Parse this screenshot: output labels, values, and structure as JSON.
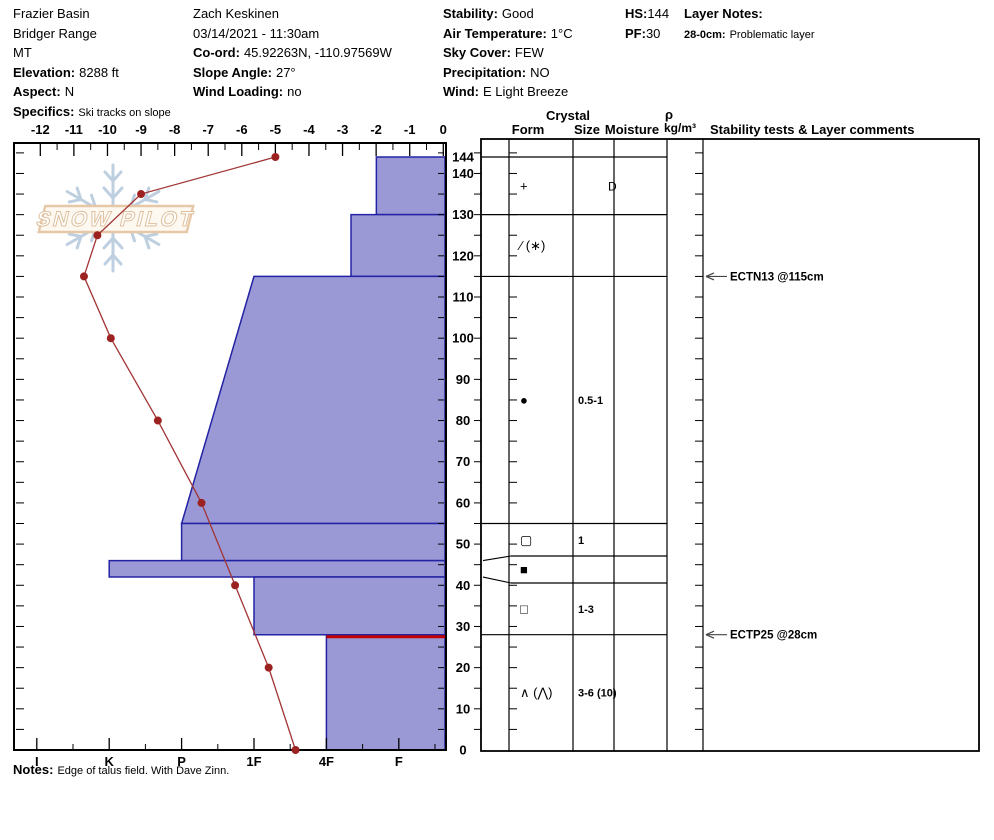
{
  "header": {
    "location": {
      "line1": "Frazier Basin",
      "line2": "Bridger Range",
      "line3": "MT",
      "elevation_label": "Elevation:",
      "elevation": "8288 ft",
      "aspect_label": "Aspect:",
      "aspect": "N",
      "specifics_label": "Specifics:",
      "specifics": "Ski tracks on slope"
    },
    "observer": {
      "name": "Zach Keskinen",
      "datetime": "03/14/2021 - 11:30am",
      "coord_label": "Co-ord:",
      "coord": "45.92263N, -110.97569W",
      "slope_label": "Slope Angle:",
      "slope": "27°",
      "wind_loading_label": "Wind Loading:",
      "wind_loading": "no"
    },
    "conditions": {
      "stability_label": "Stability:",
      "stability": "Good",
      "airtemp_label": "Air Temperature:",
      "airtemp": "1°C",
      "sky_label": "Sky Cover:",
      "sky": "FEW",
      "precip_label": "Precipitation:",
      "precip": "NO",
      "wind_label": "Wind:",
      "wind": "E Light Breeze"
    },
    "totals": {
      "hs_label": "HS:",
      "hs": "144",
      "pf_label": "PF:",
      "pf": "30"
    },
    "layer_notes": {
      "title": "Layer Notes:",
      "item_range": "28-0cm:",
      "item_text": "Problematic layer"
    }
  },
  "watermark": {
    "text": "SNOW PILOT",
    "snowflake_icon": "snowflake"
  },
  "chart_data": [
    {
      "type": "line",
      "name": "temperature-profile",
      "xlabel": "Temperature (°C)",
      "x_ticks": [
        -12,
        -11,
        -10,
        -9,
        -8,
        -7,
        -6,
        -5,
        -4,
        -3,
        -2,
        -1,
        0
      ],
      "xlim": [
        -12,
        0
      ],
      "color": "#a23535",
      "point_color": "#9c2222",
      "points": [
        {
          "depth_cm": 144,
          "temp_c": -5.0
        },
        {
          "depth_cm": 135,
          "temp_c": -9.0
        },
        {
          "depth_cm": 125,
          "temp_c": -10.3
        },
        {
          "depth_cm": 115,
          "temp_c": -10.7
        },
        {
          "depth_cm": 100,
          "temp_c": -9.9
        },
        {
          "depth_cm": 80,
          "temp_c": -8.5
        },
        {
          "depth_cm": 60,
          "temp_c": -7.2
        },
        {
          "depth_cm": 40,
          "temp_c": -6.2
        },
        {
          "depth_cm": 20,
          "temp_c": -5.2
        },
        {
          "depth_cm": 0,
          "temp_c": -4.4
        }
      ]
    },
    {
      "type": "bar",
      "name": "hand-hardness-profile",
      "orientation": "horizontal",
      "hardness_axis_labels": [
        "I",
        "K",
        "P",
        "1F",
        "4F",
        "F"
      ],
      "depth_axis_ticks": [
        144,
        140,
        130,
        120,
        110,
        100,
        90,
        80,
        70,
        60,
        50,
        40,
        30,
        20,
        10,
        0
      ],
      "ylim": [
        0,
        146
      ],
      "fill": "#9a99d6",
      "stroke": "#2323a3",
      "problem_color": "#c00000",
      "problematic_layer_line_depth_cm": 28,
      "layers": [
        {
          "top_cm": 144,
          "bottom_cm": 130,
          "hardness": "F+",
          "h_top": 1.31,
          "h_bottom": 1.31
        },
        {
          "top_cm": 130,
          "bottom_cm": 115,
          "hardness": "4F-",
          "h_top": 1.66,
          "h_bottom": 1.66
        },
        {
          "top_cm": 115,
          "bottom_cm": 55,
          "hardness": "1F→P",
          "h_top": 3,
          "h_bottom": 4
        },
        {
          "top_cm": 55,
          "bottom_cm": 46,
          "hardness": "P",
          "h_top": 4,
          "h_bottom": 4
        },
        {
          "top_cm": 46,
          "bottom_cm": 42,
          "hardness": "K",
          "h_top": 5,
          "h_bottom": 5
        },
        {
          "top_cm": 42,
          "bottom_cm": 28,
          "hardness": "1F",
          "h_top": 3,
          "h_bottom": 3
        },
        {
          "top_cm": 28,
          "bottom_cm": 0,
          "hardness": "4F",
          "h_top": 2,
          "h_bottom": 2
        }
      ]
    }
  ],
  "right_panel": {
    "headers": {
      "crystal": "Crystal",
      "form": "Form",
      "size": "Size",
      "moisture": "Moisture",
      "density": "ρ",
      "density_units": "kg/m³",
      "stability": "Stability tests & Layer comments"
    },
    "rows": [
      {
        "top_cm": 144,
        "bottom_cm": 130,
        "form": "+",
        "form_name": "precipitation-particles",
        "size": "",
        "moisture": "D"
      },
      {
        "top_cm": 130,
        "bottom_cm": 115,
        "form": "∕ (∗)",
        "form_name": "decomposing-fragments-with-stellars",
        "size": "",
        "moisture": ""
      },
      {
        "top_cm": 115,
        "bottom_cm": 55,
        "form": "●",
        "form_name": "rounded-grains",
        "size": "0.5-1",
        "moisture": ""
      },
      {
        "top_cm": 55,
        "bottom_cm": 46,
        "form": "▢",
        "form_name": "rounding-faceted-particles",
        "size": "1",
        "moisture": ""
      },
      {
        "top_cm": 46,
        "bottom_cm": 42,
        "form": "■",
        "form_name": "ice-crust",
        "size": "",
        "moisture": ""
      },
      {
        "top_cm": 42,
        "bottom_cm": 28,
        "form": "□",
        "form_name": "faceted-crystals",
        "size": "1-3",
        "moisture": ""
      },
      {
        "top_cm": 28,
        "bottom_cm": 0,
        "form": "∧ (⋀)",
        "form_name": "depth-hoar",
        "size": "3-6 (10)",
        "moisture": ""
      }
    ],
    "stability_tests": [
      {
        "label": "ECTN13 @115cm",
        "depth_cm": 115
      },
      {
        "label": "ECTP25 @28cm",
        "depth_cm": 28
      }
    ]
  },
  "notes": {
    "label": "Notes:",
    "text": "Edge of talus field. With Dave Zinn."
  }
}
